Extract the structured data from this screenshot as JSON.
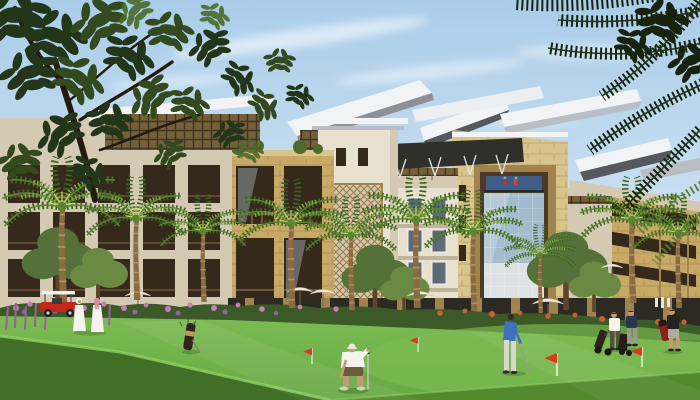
{
  "meta": {
    "description": "Architectural rendering of a sandstone resort hotel complex with butterfly winged roofs, glass curtain walls, palm trees and a golf course green in the foreground with golfers, red pin flags, a red golf cart and two robed walkers",
    "width": 700,
    "height": 400
  },
  "scene": {
    "entities": [
      "sky-with-clouds",
      "overhanging-tree-left",
      "overhanging-palm-fronds-right",
      "left-apartment-building",
      "pergola-roof",
      "white-tower-mashrabiya",
      "winged-roofs",
      "cream-midrise",
      "stone-portal-tower",
      "glass-curtain-wall",
      "right-stone-wing",
      "palm-trees",
      "flower-hedge",
      "white-umbrellas",
      "golf-lawn",
      "crouching-golfer",
      "putting-golfer-blue",
      "golfer-white-shirt",
      "golfer-navy",
      "walking-man-black-shirt",
      "robed-couple",
      "red-golf-cart",
      "standing-golf-bag",
      "red-pin-flags"
    ]
  },
  "palette": {
    "sky_top": "#a9cde9",
    "sky_mid": "#cfe2f1",
    "sky_bottom": "#ebf2f7",
    "cloud": "#ffffff",
    "roof_white": "#f1f3f4",
    "roof_gray": "#b9bec4",
    "roof_edge": "#55585c",
    "canopy_dark": "#2f3029",
    "cream": "#e9e1d0",
    "cream_shadow": "#d4c9b2",
    "cream_dark": "#bfb49c",
    "stone": "#c8a965",
    "stone_light": "#d9c48c",
    "stone_dark": "#a3834c",
    "stone_deep": "#76592f",
    "lattice": "#75603a",
    "window_dark": "#35291c",
    "glass_blue": "#a3bccd",
    "glass_deep": "#3f5d88",
    "glass_panel": "#dde2e5",
    "glass_gray": "#5d6b78",
    "foliage_darkest": "#18230f",
    "foliage_dark": "#24361a",
    "foliage_mid": "#33491f",
    "foliage_light": "#4c6a2b",
    "tree_olive": "#55713a",
    "tree_olive_light": "#6a8a43",
    "palm_dark": "#3e6424",
    "palm_mid": "#5c8430",
    "palm_light": "#85a844",
    "palm_yellow": "#c9cf6a",
    "trunk": "#8a6b42",
    "trunk_light": "#bb9a66",
    "hedge": "#3b5a27",
    "flower_pink": "#c77fb4",
    "flower_violet": "#9a5f9e",
    "flower_orange": "#c7622f",
    "umbrella": "#efe9dc",
    "umbrella_edge": "#c9c2b2",
    "lawn_light": "#7cbb52",
    "lawn_mid": "#68a945",
    "lawn_dark": "#53892f",
    "lawn_deep": "#416f27",
    "fringe": "#8ed163",
    "flag_red": "#d93a1f",
    "cart_red": "#c2271a",
    "white_cloth": "#f5f3ed",
    "pink_scarf": "#d98ba6",
    "blue_shirt": "#3f6fc0",
    "navy": "#2a3550",
    "black_cloth": "#23231f",
    "gray_pants": "#d8d6cf",
    "olive_pants": "#55523e",
    "khaki_shorts": "#6e5b3a",
    "skin": "#c49a72",
    "bag_dark": "#2e241a",
    "bag_red": "#8e1f1c",
    "pole_white": "#f2f2f2",
    "shaft_gray": "#cfcfcf"
  }
}
